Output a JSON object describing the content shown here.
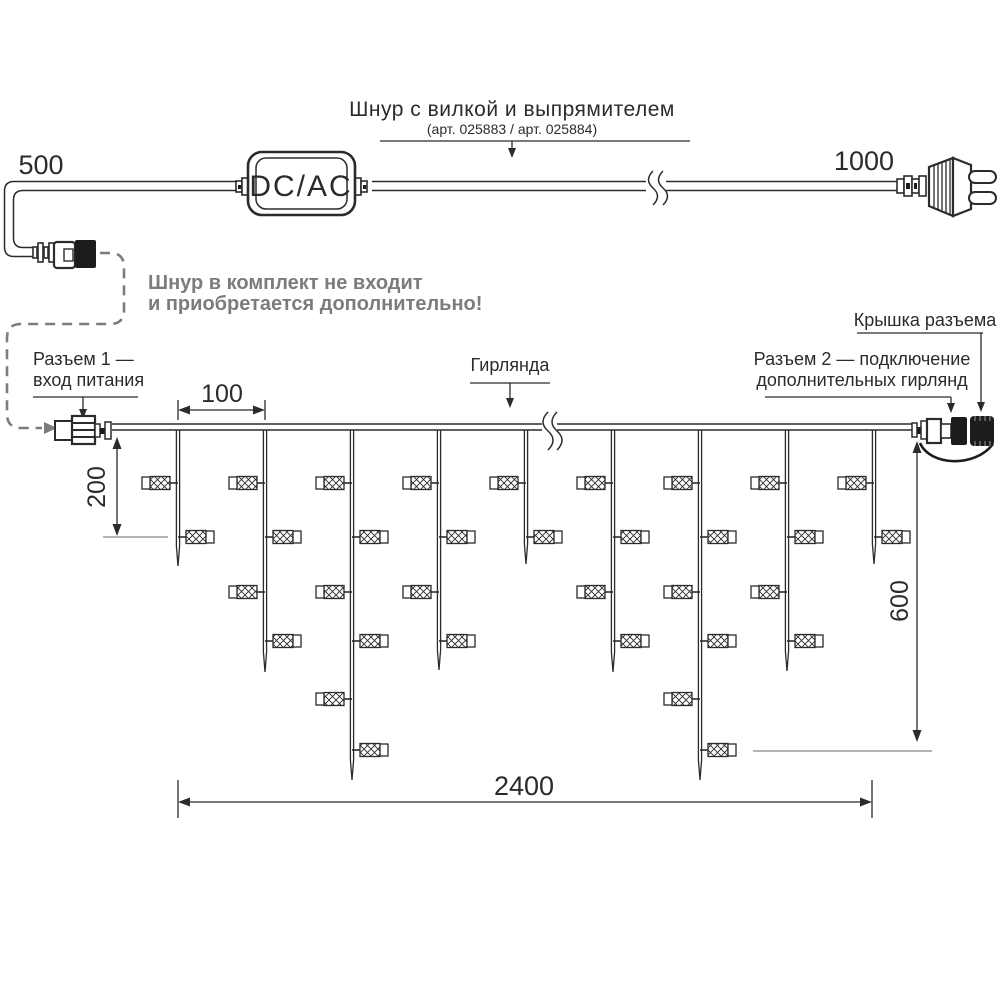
{
  "diagram": {
    "background": "#ffffff",
    "line_color": "#2b2b2b",
    "muted_color": "#7c7c7c"
  },
  "power_cord": {
    "label_line1": "Шнур с вилкой и выпрямителем",
    "label_line2": "(арт. 025883 / арт. 025884)",
    "converter_label": "DC/AC",
    "length_left": "500",
    "length_right": "1000"
  },
  "notes": {
    "not_included_line1": "Шнур в комплект не входит",
    "not_included_line2": "и приобретается дополнительно!"
  },
  "callouts": {
    "connector1_line1": "Разъем 1 —",
    "connector1_line2": "вход питания",
    "garland": "Гирлянда",
    "connector2_line1": "Разъем 2 — подключение",
    "connector2_line2": "дополнительных гирлянд",
    "cap": "Крышка разъема"
  },
  "dimensions": {
    "drop_spacing": "100",
    "short_drop": "200",
    "long_drop": "600",
    "total_length": "2400"
  },
  "garland": {
    "wire_y": 427,
    "bulb_rows_y": [
      483,
      537,
      592,
      641,
      699,
      750
    ],
    "drops": [
      {
        "x": 178,
        "tip_y": 566,
        "bulbs": 2
      },
      {
        "x": 265,
        "tip_y": 672,
        "bulbs": 4
      },
      {
        "x": 352,
        "tip_y": 780,
        "bulbs": 6
      },
      {
        "x": 439,
        "tip_y": 670,
        "bulbs": 4
      },
      {
        "x": 526,
        "tip_y": 564,
        "bulbs": 2
      },
      {
        "x": 613,
        "tip_y": 672,
        "bulbs": 4
      },
      {
        "x": 700,
        "tip_y": 780,
        "bulbs": 6
      },
      {
        "x": 787,
        "tip_y": 671,
        "bulbs": 4
      },
      {
        "x": 874,
        "tip_y": 564,
        "bulbs": 2
      }
    ]
  }
}
